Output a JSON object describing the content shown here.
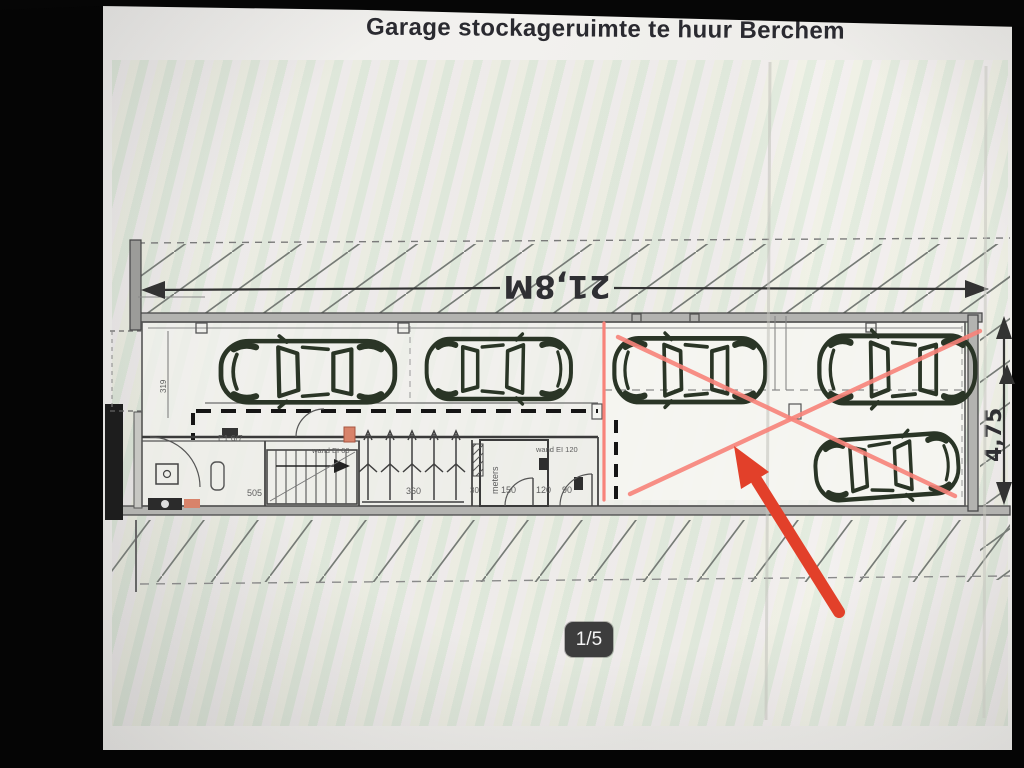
{
  "viewer": {
    "title": "Garage stockageruimte te huur Berchem",
    "counter": "1/5"
  },
  "plan": {
    "dimensions": {
      "total_width": "21,8M",
      "depth": "4,75",
      "entrance": "319",
      "corridor": "505",
      "bike_area": "360",
      "w150": "150",
      "w120": "120",
      "w90": "90",
      "w30": "30"
    },
    "labels": {
      "meter_room": "meters",
      "wall_ei60": "wand EI 60",
      "wall_ei120": "wand EI 120",
      "door": "E1 6/7"
    },
    "annotations": {
      "cars_drawn": 5,
      "crossed_out_cars": 3
    },
    "colors": {
      "marker_red": "#e2402a",
      "cross_pink": "#f8837a",
      "car_ink": "#2a3526"
    }
  }
}
